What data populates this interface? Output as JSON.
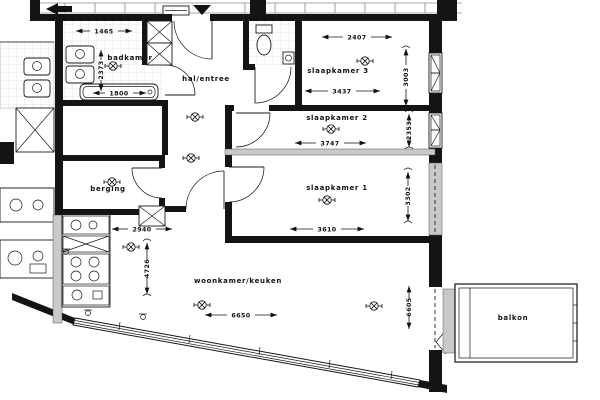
{
  "meta": {
    "drawing_type": "floor-plan",
    "language": "nl"
  },
  "colors": {
    "wall": "#141414",
    "light_wall": "#c9c9c9",
    "background": "#ffffff",
    "tile_line": "#d5d5d5"
  },
  "rooms": {
    "badkamer": {
      "label": "badkamer"
    },
    "hal": {
      "label": "hal/entree"
    },
    "slaapkamer3": {
      "label": "slaapkamer 3"
    },
    "slaapkamer2": {
      "label": "slaapkamer 2"
    },
    "slaapkamer1": {
      "label": "slaapkamer 1"
    },
    "berging": {
      "label": "berging"
    },
    "woonkamer": {
      "label": "woonkamer/keuken"
    },
    "balkon": {
      "label": "balkon"
    }
  },
  "dims": {
    "badkamer_breedte": "1465",
    "badkamer_diepte": "2373",
    "bad_lengte": "1800",
    "slaapkamer3_breedte": "2407",
    "slaapkamer3_diepte": "3003",
    "slaapkamer3_breedte_2": "3437",
    "slaapkamer2_breedte": "3747",
    "slaapkamer2_diepte": "2353",
    "slaapkamer1_breedte": "3610",
    "slaapkamer1_diepte": "3302",
    "hal_breedte": "2940",
    "woonkamer_breedte": "6650",
    "woonkamer_diepte": "6605",
    "keuken_diepte": "4726"
  }
}
